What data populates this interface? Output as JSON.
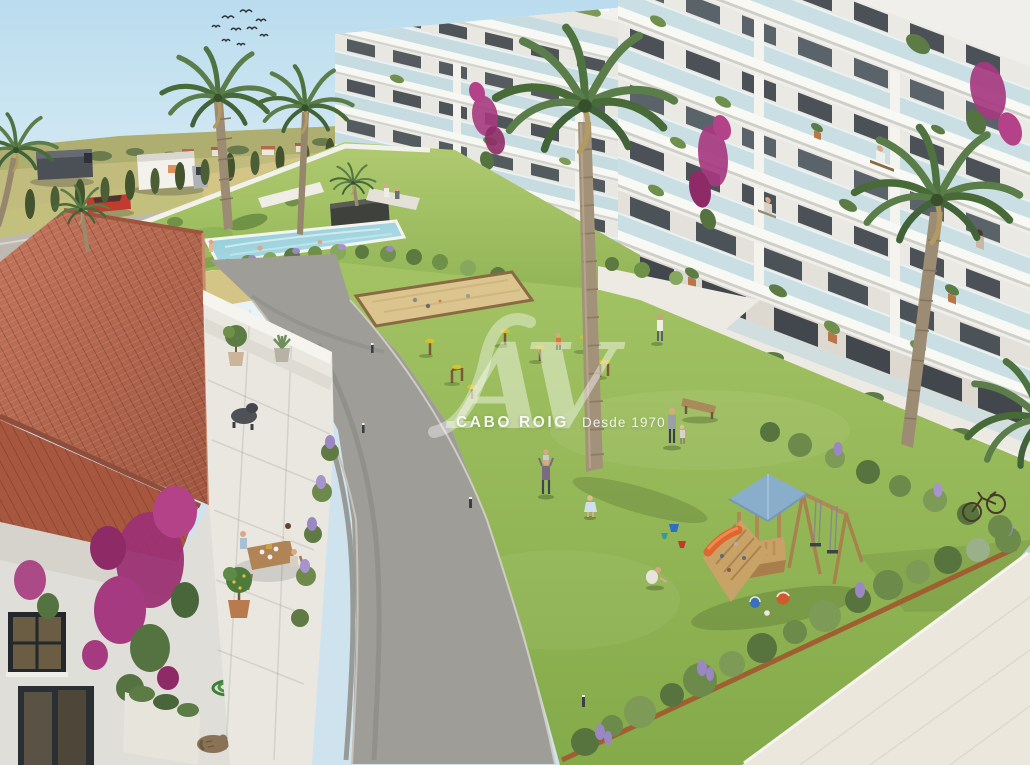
{
  "watermark": {
    "logo": "AV",
    "brand": "CABO ROIG",
    "tagline": "Desde 1970"
  },
  "palette": {
    "sky": "#c6e0ee",
    "fields": "#d4c486",
    "grass_courtyard": "#9cbf5e",
    "grass_garden": "#a6c468",
    "pool_water": "#9fd4de",
    "asphalt_road": "#9e9d98",
    "stone_path": "#ebe7dd",
    "villa_roof_tiles": "#b2604a",
    "bougainvillea": "#a63a80",
    "building_white": "#f3f3ef",
    "balcony_glass": "#c2dbe1",
    "playground_wood": "#c49a63",
    "playground_roof": "#8badc9",
    "cypress_green": "#42532e",
    "lavender": "#9b87c2"
  }
}
